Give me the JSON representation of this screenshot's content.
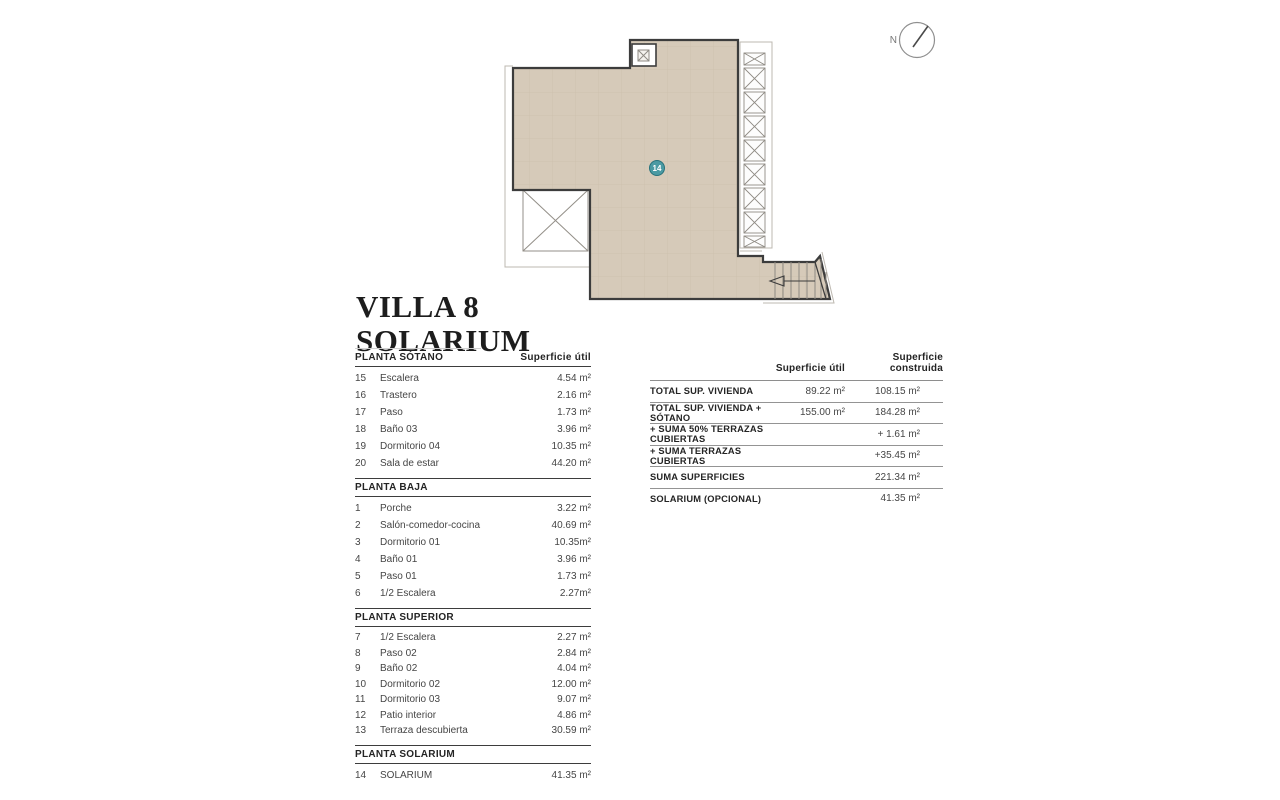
{
  "title": {
    "line1": "VILLA 8",
    "line2": "SOLARIUM"
  },
  "plan": {
    "unit_badge": "14",
    "north_label": "N",
    "fill_color": "#d6cab9",
    "wall_color": "#3c3c3c",
    "badge_color": "#4b9aa3"
  },
  "left_table": {
    "area_header": "Superficie útil",
    "sections": [
      {
        "name": "PLANTA SÓTANO",
        "rows": [
          [
            "15",
            "Escalera",
            "4.54 m²"
          ],
          [
            "16",
            "Trastero",
            "2.16 m²"
          ],
          [
            "17",
            "Paso",
            "1.73 m²"
          ],
          [
            "18",
            "Baño 03",
            "3.96 m²"
          ],
          [
            "19",
            "Dormitorio 04",
            "10.35 m²"
          ],
          [
            "20",
            "Sala de estar",
            "44.20 m²"
          ]
        ]
      },
      {
        "name": "PLANTA BAJA",
        "rows": [
          [
            "1",
            "Porche",
            "3.22 m²"
          ],
          [
            "2",
            "Salón-comedor-cocina",
            "40.69 m²"
          ],
          [
            "3",
            "Dormitorio 01",
            "10.35m²"
          ],
          [
            "4",
            "Baño 01",
            "3.96 m²"
          ],
          [
            "5",
            "Paso 01",
            "1.73 m²"
          ],
          [
            "6",
            "1/2 Escalera",
            "2.27m²"
          ]
        ]
      },
      {
        "name": "PLANTA SUPERIOR",
        "rows": [
          [
            "7",
            "1/2 Escalera",
            "2.27 m²"
          ],
          [
            "8",
            "Paso 02",
            "2.84 m²"
          ],
          [
            "9",
            "Baño 02",
            "4.04 m²"
          ],
          [
            "10",
            "Dormitorio 02",
            "12.00 m²"
          ],
          [
            "11",
            "Dormitorio 03",
            "9.07 m²"
          ],
          [
            "12",
            "Patio interior",
            "4.86 m²"
          ],
          [
            "13",
            "Terraza descubierta",
            "30.59 m²"
          ]
        ]
      },
      {
        "name": "PLANTA SOLARIUM",
        "rows": [
          [
            "14",
            "SOLARIUM",
            "41.35 m²"
          ]
        ]
      }
    ]
  },
  "summary_table": {
    "util_header": "Superficie útil",
    "built_header": "Superficie construida",
    "rows": [
      {
        "label": "TOTAL SUP. VIVIENDA",
        "util": "89.22 m²",
        "built": "108.15 m²"
      },
      {
        "label": "TOTAL SUP. VIVIENDA + SÓTANO",
        "util": "155.00 m²",
        "built": "184.28 m²"
      },
      {
        "label": "+ SUMA 50% TERRAZAS CUBIERTAS",
        "util": "",
        "built": "+ 1.61 m²"
      },
      {
        "label": "+ SUMA TERRAZAS CUBIERTAS",
        "util": "",
        "built": "+35.45 m²"
      },
      {
        "label": "SUMA SUPERFICIES",
        "util": "",
        "built": "221.34 m²"
      },
      {
        "label": "SOLARIUM (OPCIONAL)",
        "util": "",
        "built": "41.35 m²"
      }
    ]
  }
}
